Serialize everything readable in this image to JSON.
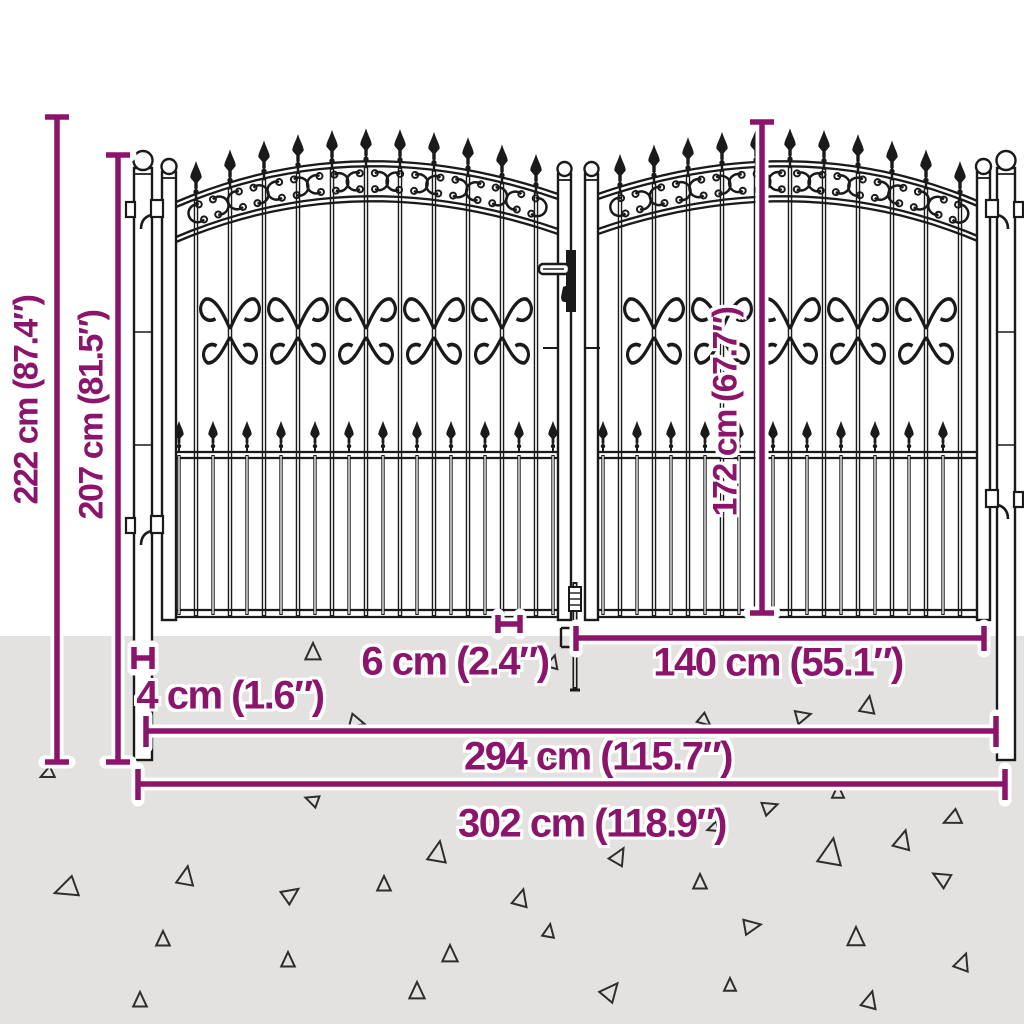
{
  "colors": {
    "dimension_accent": "#8C156C",
    "ground": "#E3E2E1",
    "line_art": "#1A1A1A",
    "label_halo": "#FFFFFF"
  },
  "diagram": {
    "subject": "ornamental double garden gate with spear tops and scroll work, shown with fence posts on grey ground",
    "style": "black technical line drawing with magenta dimension callouts",
    "dimensions": {
      "total_height": {
        "label": "222 cm (87.4″)",
        "cm": 222,
        "inches": 87.4
      },
      "post_height": {
        "label": "207 cm (81.5″)",
        "cm": 207,
        "inches": 81.5
      },
      "leaf_height": {
        "label": "172 cm (67.7″)",
        "cm": 172,
        "inches": 67.7
      },
      "ground_clearance": {
        "label": "6 cm (2.4″)",
        "cm": 6,
        "inches": 2.4
      },
      "post_width": {
        "label": "4 cm (1.6″)",
        "cm": 4,
        "inches": 1.6
      },
      "leaf_width": {
        "label": "140 cm (55.1″)",
        "cm": 140,
        "inches": 55.1
      },
      "width_between_posts": {
        "label": "294 cm (115.7″)",
        "cm": 294,
        "inches": 115.7
      },
      "total_width": {
        "label": "302 cm (118.9″)",
        "cm": 302,
        "inches": 118.9
      }
    }
  }
}
